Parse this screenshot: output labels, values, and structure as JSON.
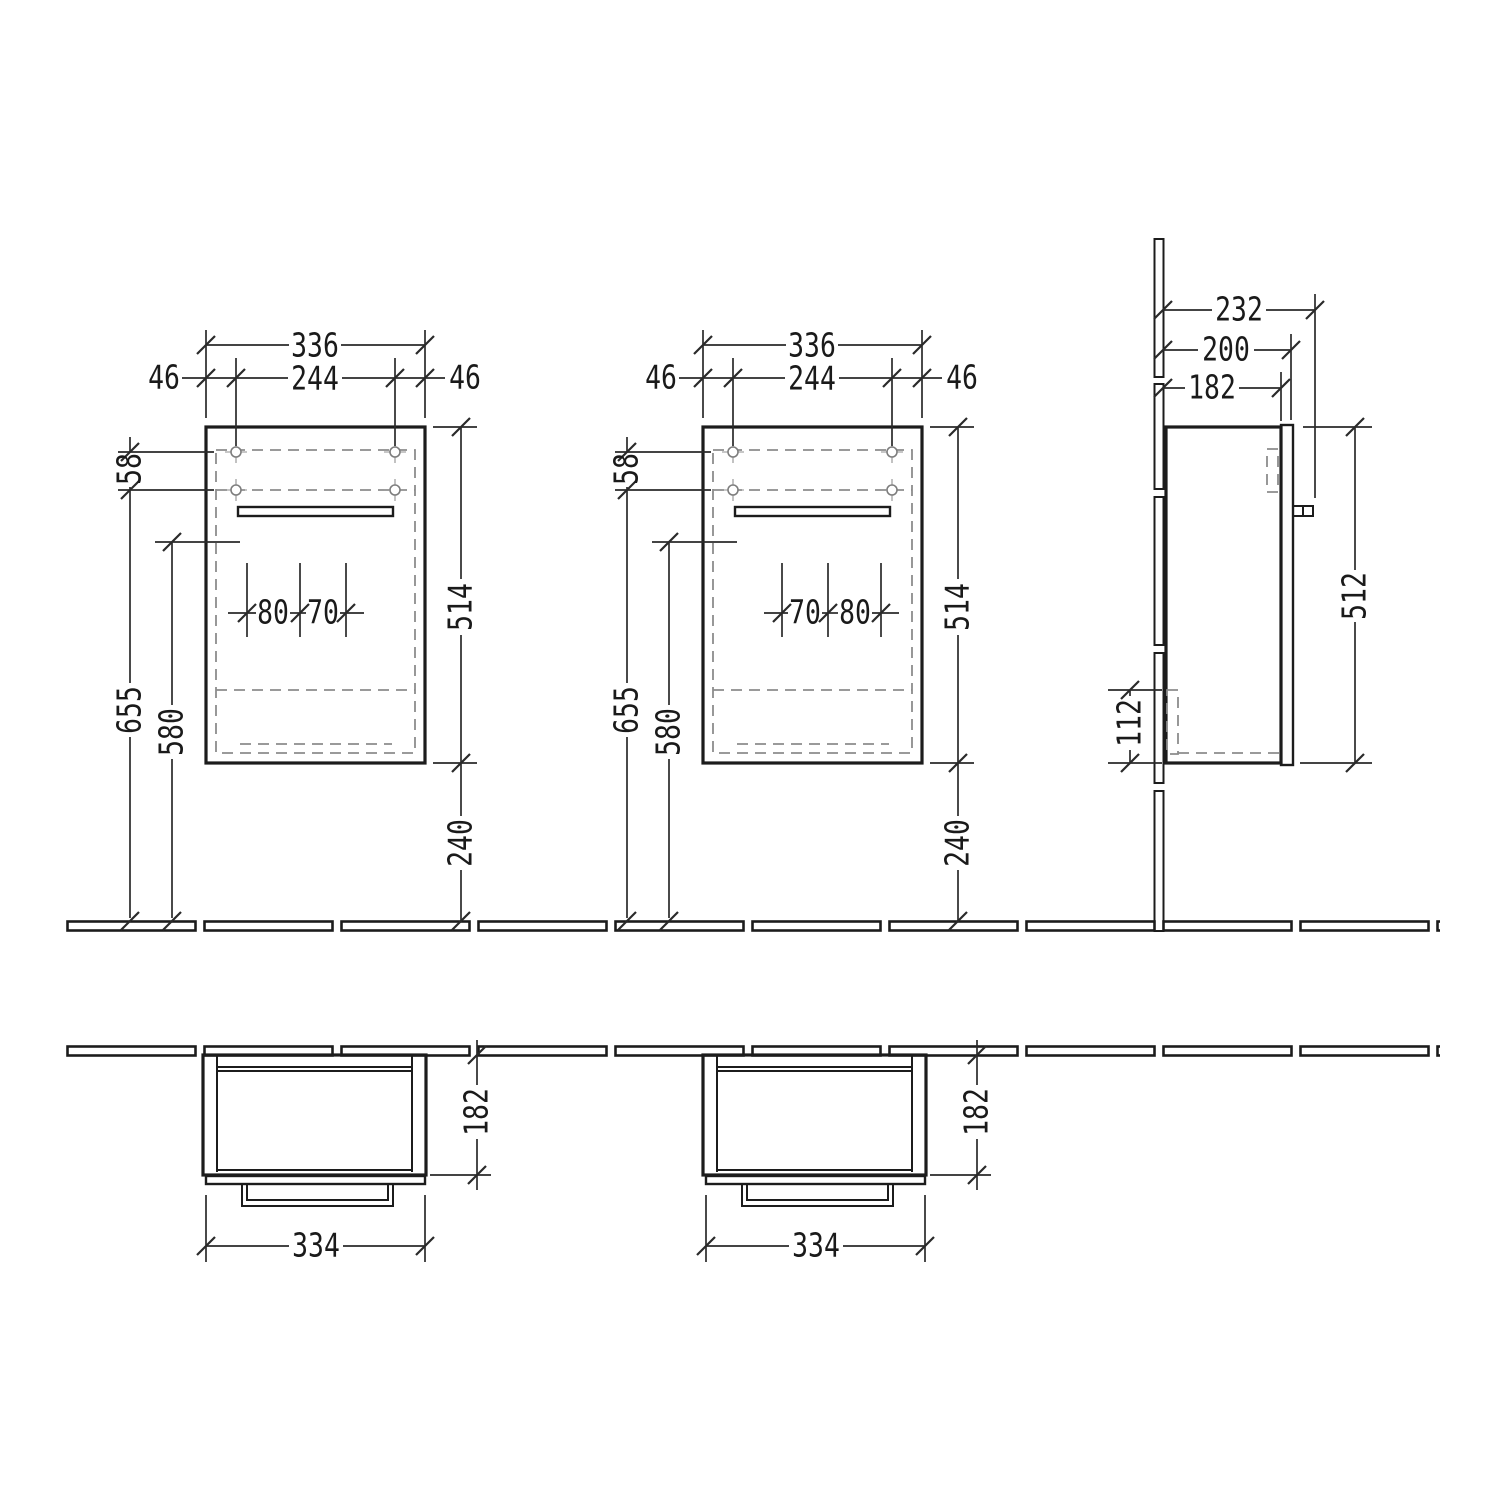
{
  "drawing_title": "vanity-unit-dimension-drawing",
  "units": "mm",
  "dims": {
    "front_left": {
      "overall_width": "336",
      "hole_spacing": "244",
      "edge_offset_left": "46",
      "edge_offset_right": "46",
      "hole_row_gap": "58",
      "body_height": "514",
      "floor_clearance": "240",
      "fixing_height": "655",
      "reference_height": "580",
      "cutout_left": "80",
      "cutout_right": "70"
    },
    "front_center": {
      "overall_width": "336",
      "hole_spacing": "244",
      "edge_offset_left": "46",
      "edge_offset_right": "46",
      "hole_row_gap": "58",
      "body_height": "514",
      "floor_clearance": "240",
      "fixing_height": "655",
      "reference_height": "580",
      "cutout_left": "70",
      "cutout_right": "80"
    },
    "side": {
      "total_depth": "232",
      "door_depth": "200",
      "body_depth": "182",
      "door_height": "512",
      "bottom_zone": "112"
    },
    "plan_left": {
      "width": "334",
      "depth": "182"
    },
    "plan_right": {
      "width": "334",
      "depth": "182"
    }
  },
  "line_colors": {
    "outline": "#1c1c1c",
    "dimension": "#2a2a2a",
    "hidden_dashed": "#8c8c8c"
  }
}
